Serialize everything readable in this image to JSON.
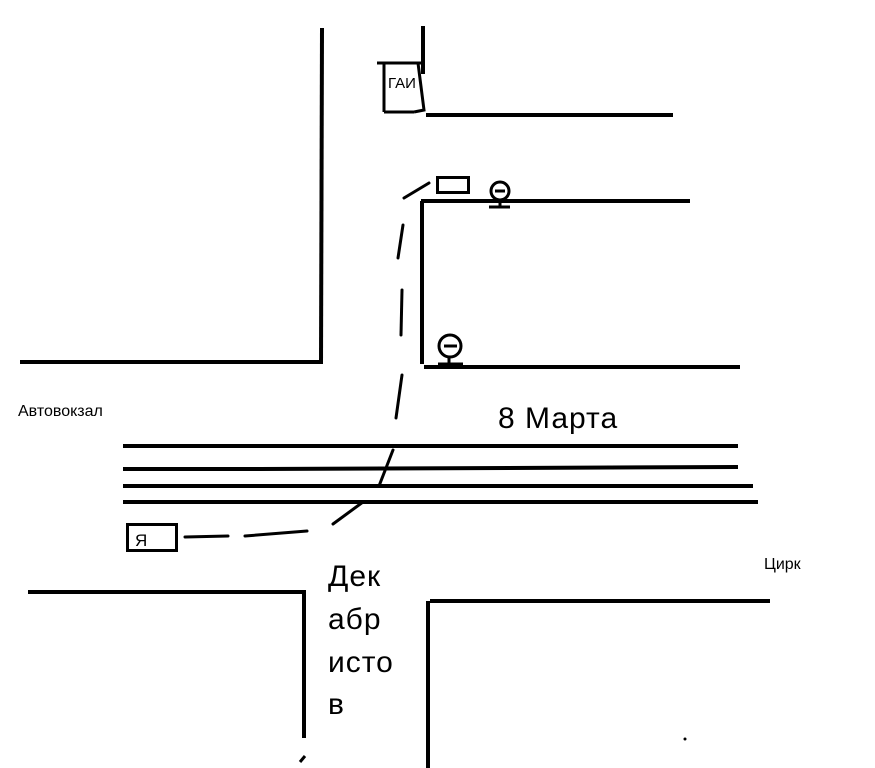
{
  "canvas": {
    "width": 875,
    "height": 768,
    "background_color": "#ffffff",
    "ink_color": "#000000",
    "style": "hand-drawn paint sketch map"
  },
  "labels": {
    "gai_post": "ГАИ",
    "bus_station": "Автовокзал",
    "marta_street": "8 Марта",
    "me_marker": "Я",
    "circus": "Цирк",
    "dekabristov_lines": [
      "Дек",
      "абр",
      "исто",
      "в"
    ]
  },
  "icons": {
    "upper_sign": "round-traffic-sign-icon",
    "lower_sign": "round-traffic-sign-icon",
    "stop_marker": "stop-rectangle-icon"
  },
  "route": {
    "style": "dashed-freehand-line"
  }
}
